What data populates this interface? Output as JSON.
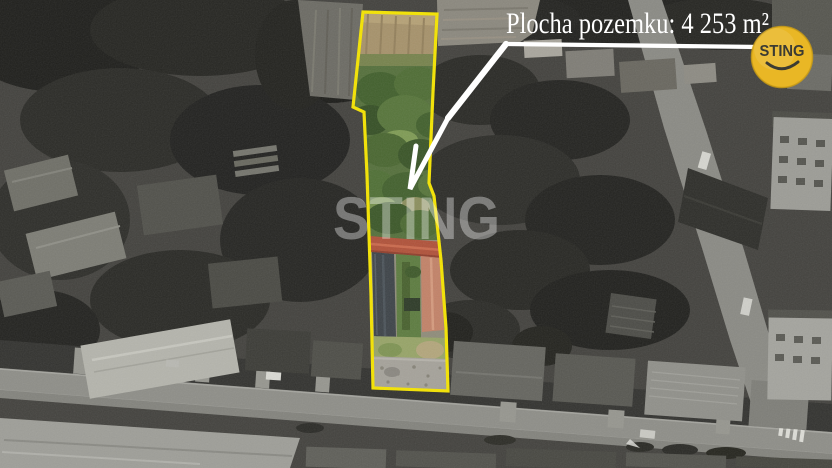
{
  "callout": {
    "label": "Plocha pozemku: 4 253 m²",
    "area_value": "4 253",
    "area_unit": "m²"
  },
  "watermark": {
    "text": "STING"
  },
  "logo": {
    "brand": "STING"
  },
  "colors": {
    "parcel_outline": "#F5E400",
    "callout_text": "#FFFFFF",
    "callout_line": "#FFFFFF",
    "watermark_text": "#FFFFFF",
    "logo_circle": "#E9B725",
    "logo_rim": "#CC9D14",
    "logo_text": "#3B3B33"
  }
}
